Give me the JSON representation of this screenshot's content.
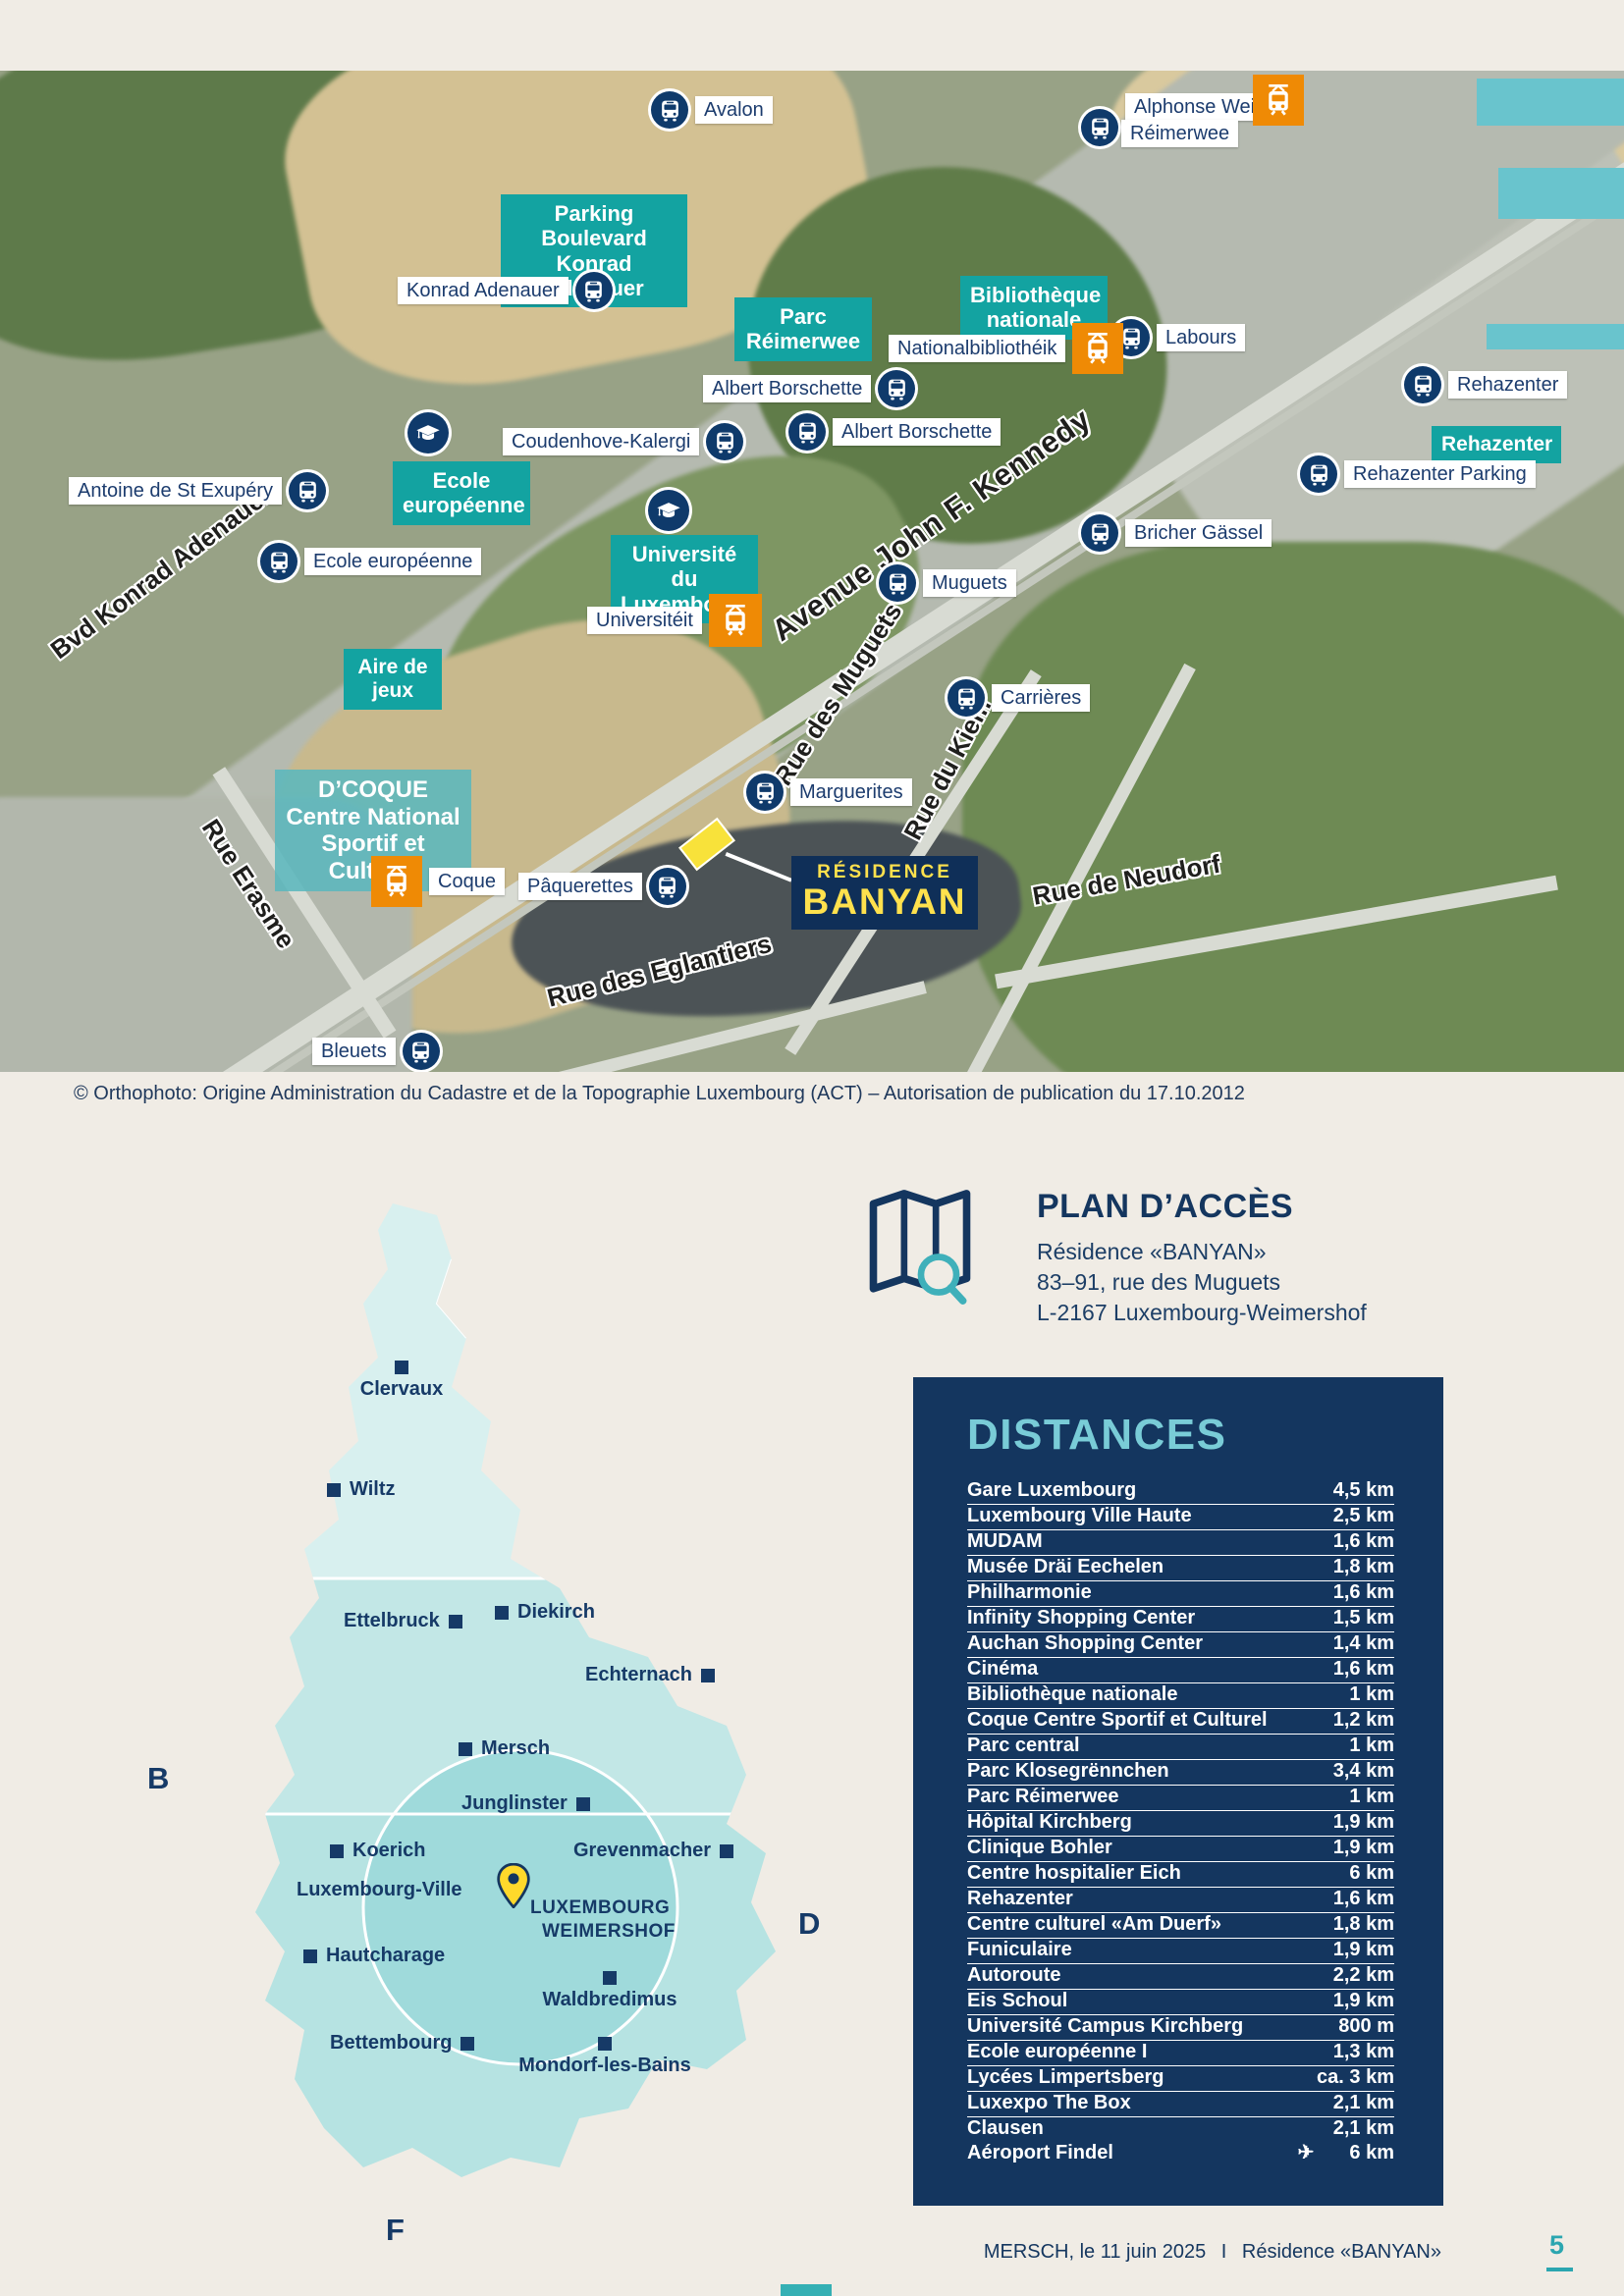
{
  "map": {
    "stops": {
      "avalon": "Avalon",
      "alphonse_weicker": "Alphonse Weicker",
      "reimerwee": "Réimerwee",
      "konrad_adenauer": "Konrad Adenauer",
      "labours": "Labours",
      "albert_borschette_1": "Albert Borschette",
      "albert_borschette_2": "Albert Borschette",
      "rehazenter": "Rehazenter",
      "rehazenter_parking": "Rehazenter Parking",
      "bricher_gassel": "Bricher Gässel",
      "coudenhove_kalergi": "Coudenhove-Kalergi",
      "antoine_st_exupery": "Antoine de St Exupéry",
      "ecole_europeenne": "Ecole européenne",
      "muguets": "Muguets",
      "carrieres": "Carrières",
      "marguerites": "Marguerites",
      "paquerettes": "Pâquerettes",
      "bleuets": "Bleuets",
      "universiteit": "Universitéit",
      "nationalbibliotheik": "Nationalbibliothéik",
      "coque": "Coque"
    },
    "places": {
      "parking_line1": "Parking Boulevard",
      "parking_line2": "Konrad Adenauer",
      "parc_line1": "Parc",
      "parc_line2": "Réimerwee",
      "biblio_line1": "Bibliothèque",
      "biblio_line2": "nationale",
      "rehazenter_box": "Rehazenter",
      "ecole_line1": "Ecole",
      "ecole_line2": "européenne",
      "uni_line1": "Université du",
      "uni_line2": "Luxembourg",
      "aire_line1": "Aire de",
      "aire_line2": "jeux",
      "coque_line1": "D’COQUE",
      "coque_line2": "Centre National",
      "coque_line3": "Sportif et Culturel"
    },
    "streets": {
      "kennedy": "Avenue John F. Kennedy",
      "adenauer": "Bvd Konrad Adenauer",
      "muguets": "Rue des Muguets",
      "kiem": "Rue du Kiem",
      "neudorf": "Rue de Neudorf",
      "eglantiers": "Rue des Eglantiers",
      "erasme": "Rue Erasme"
    },
    "residence": {
      "line1": "RÉSIDENCE",
      "line2": "BANYAN"
    },
    "copyright": "© Orthophoto: Origine Administration du Cadastre et de la Topographie Luxembourg (ACT) – Autorisation de publication du 17.10.2012"
  },
  "country": {
    "cities": {
      "clervaux": "Clervaux",
      "wiltz": "Wiltz",
      "ettelbruck": "Ettelbruck",
      "diekirch": "Diekirch",
      "echternach": "Echternach",
      "mersch": "Mersch",
      "junglinster": "Junglinster",
      "grevenmacher": "Grevenmacher",
      "koerich": "Koerich",
      "luxembourg_ville": "Luxembourg-Ville",
      "hautcharage": "Hautcharage",
      "waldbredimus": "Waldbredimus",
      "bettembourg": "Bettembourg",
      "mondorf": "Mondorf-les-Bains"
    },
    "highlight_line1": "LUXEMBOURG",
    "highlight_line2": "WEIMERSHOF",
    "letter_b": "B",
    "letter_d": "D",
    "letter_f": "F"
  },
  "access": {
    "title": "PLAN D’ACCÈS",
    "line1": "Résidence «BANYAN»",
    "line2": "83–91, rue des Muguets",
    "line3": "L-2167 Luxembourg-Weimershof"
  },
  "distances": {
    "title": "DISTANCES",
    "rows": [
      {
        "name": "Gare Luxembourg",
        "value": "4,5 km"
      },
      {
        "name": "Luxembourg Ville Haute",
        "value": "2,5 km"
      },
      {
        "name": "MUDAM",
        "value": "1,6 km"
      },
      {
        "name": "Musée Dräi Eechelen",
        "value": "1,8 km"
      },
      {
        "name": "Philharmonie",
        "value": "1,6 km"
      },
      {
        "name": "Infinity Shopping Center",
        "value": "1,5 km"
      },
      {
        "name": "Auchan Shopping Center",
        "value": "1,4 km"
      },
      {
        "name": "Cinéma",
        "value": "1,6 km"
      },
      {
        "name": "Bibliothèque nationale",
        "value": "1 km"
      },
      {
        "name": "Coque Centre Sportif et Culturel",
        "value": "1,2 km"
      },
      {
        "name": "Parc central",
        "value": "1 km"
      },
      {
        "name": "Parc Klosegrënnchen",
        "value": "3,4 km"
      },
      {
        "name": "Parc Réimerwee",
        "value": "1 km"
      },
      {
        "name": "Hôpital Kirchberg",
        "value": "1,9 km"
      },
      {
        "name": "Clinique Bohler",
        "value": "1,9 km"
      },
      {
        "name": "Centre hospitalier Eich",
        "value": "6 km"
      },
      {
        "name": "Rehazenter",
        "value": "1,6 km"
      },
      {
        "name": "Centre culturel «Am Duerf»",
        "value": "1,8 km"
      },
      {
        "name": "Funiculaire",
        "value": "1,9 km"
      },
      {
        "name": "Autoroute",
        "value": "2,2 km"
      },
      {
        "name": "Eis Schoul",
        "value": "1,9 km"
      },
      {
        "name": "Université Campus Kirchberg",
        "value": "800 m"
      },
      {
        "name": "Ecole européenne I",
        "value": "1,3 km"
      },
      {
        "name": "Lycées Limpertsberg",
        "value": "ca. 3 km"
      },
      {
        "name": "Luxexpo The Box",
        "value": "2,1 km"
      },
      {
        "name": "Clausen",
        "value": "2,1 km"
      }
    ],
    "airport": {
      "name": "Aéroport Findel",
      "value": "6 km"
    },
    "airport_icon": "✈"
  },
  "footer": {
    "date_place": "MERSCH, le 11 juin 2025",
    "separator": "I",
    "residence": "Résidence «BANYAN»",
    "page": "5"
  },
  "colors": {
    "teal": "#13a3a1",
    "navy": "#14365f",
    "orange": "#ef8a05",
    "yellow": "#f8e23a",
    "light_teal": "#69c4cd",
    "table_title": "#79ccd7"
  }
}
